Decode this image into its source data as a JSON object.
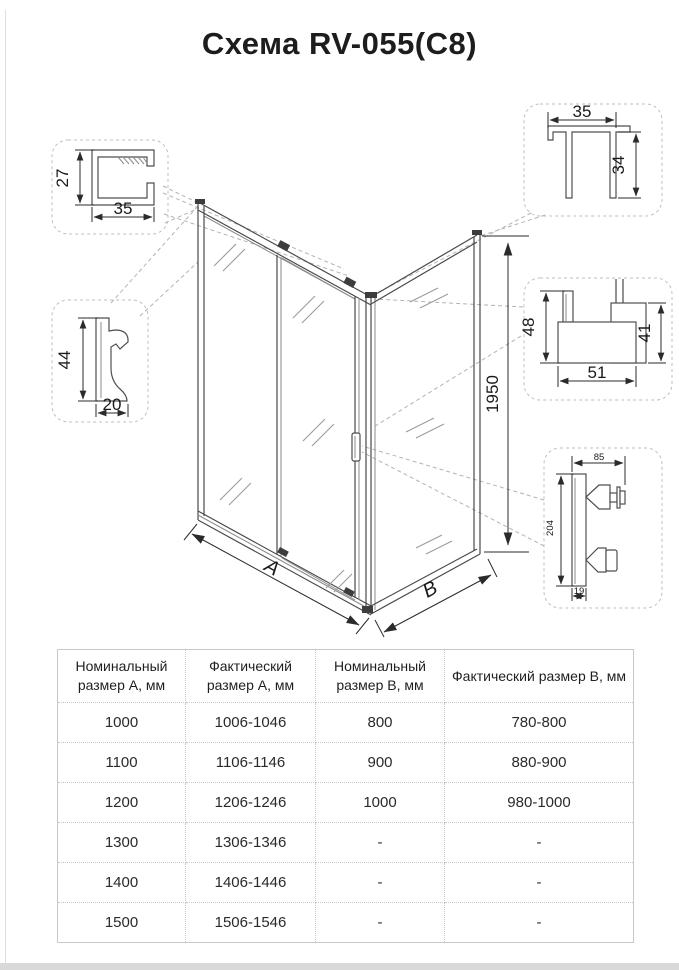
{
  "title": "Схема RV-055(C8)",
  "colors": {
    "accent_blue": "#2f5e80",
    "line": "#4a4a4a"
  },
  "diagram": {
    "callouts": {
      "top_track_profile": {
        "height": "27",
        "width": "35"
      },
      "wall_profile": {
        "height": "44",
        "width": "20"
      },
      "top_corner_profile": {
        "width": "35",
        "height": "34"
      },
      "bottom_rail_profile": {
        "height_left": "48",
        "height_right": "41",
        "width": "51"
      },
      "handle": {
        "width": "85",
        "length": "204",
        "depth": "19"
      }
    },
    "enclosure": {
      "height": "1950",
      "width_label": "A",
      "depth_label": "B"
    }
  },
  "table": {
    "headers": [
      "Номинальный размер А, мм",
      "Фактический размер А, мм",
      "Номинальный размер В, мм",
      "Фактический размер В, мм"
    ],
    "rows": [
      [
        "1000",
        "1006-1046",
        "800",
        "780-800"
      ],
      [
        "1100",
        "1106-1146",
        "900",
        "880-900"
      ],
      [
        "1200",
        "1206-1246",
        "1000",
        "980-1000"
      ],
      [
        "1300",
        "1306-1346",
        "-",
        "-"
      ],
      [
        "1400",
        "1406-1446",
        "-",
        "-"
      ],
      [
        "1500",
        "1506-1546",
        "-",
        "-"
      ]
    ]
  }
}
